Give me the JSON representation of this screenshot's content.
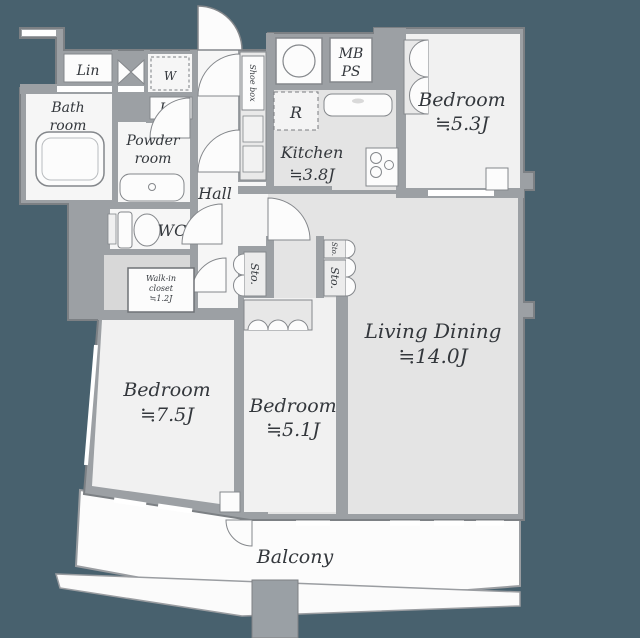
{
  "plan": {
    "rooms": {
      "bedroom_a": {
        "label": "Bedroom",
        "area": "≒5.3J"
      },
      "bedroom_b": {
        "label": "Bedroom",
        "area": "≒7.5J"
      },
      "bedroom_c": {
        "label": "Bedroom",
        "area": "≒5.1J"
      },
      "living_dining": {
        "label": "Living Dining",
        "area": "≒14.0J"
      },
      "kitchen": {
        "label": "Kitchen",
        "area": "≒3.8J"
      },
      "bathroom": {
        "line1": "Bath",
        "line2": "room"
      },
      "powder_room": {
        "line1": "Powder",
        "line2": "room"
      },
      "hall": {
        "label": "Hall"
      },
      "wc": {
        "label": "WC"
      },
      "walk_in_closet": {
        "line1": "Walk-in",
        "line2": "closet",
        "line3": "≒1.2J"
      },
      "balcony": {
        "label": "Balcony"
      }
    },
    "fixtures": {
      "linen_top": "Lin",
      "linen_mid": "Lin",
      "washer": "W",
      "refrigerator": "R",
      "meter_box_line1": "MB",
      "meter_box_line2": "PS",
      "shoe_box": "Shoe box",
      "storage_hall": "Sto.",
      "storage_living_small": "Sto.",
      "storage_living": "Sto."
    },
    "colors": {
      "background": "#48616e",
      "wall": "#9ca0a4",
      "wall_edge": "#7c8084",
      "room_light": "#f6f6f6",
      "room_mid": "#e4e4e4",
      "bedroom_floor": "#f1f1f1",
      "closet_gray": "#d8d8d8",
      "text": "#33373c"
    }
  }
}
